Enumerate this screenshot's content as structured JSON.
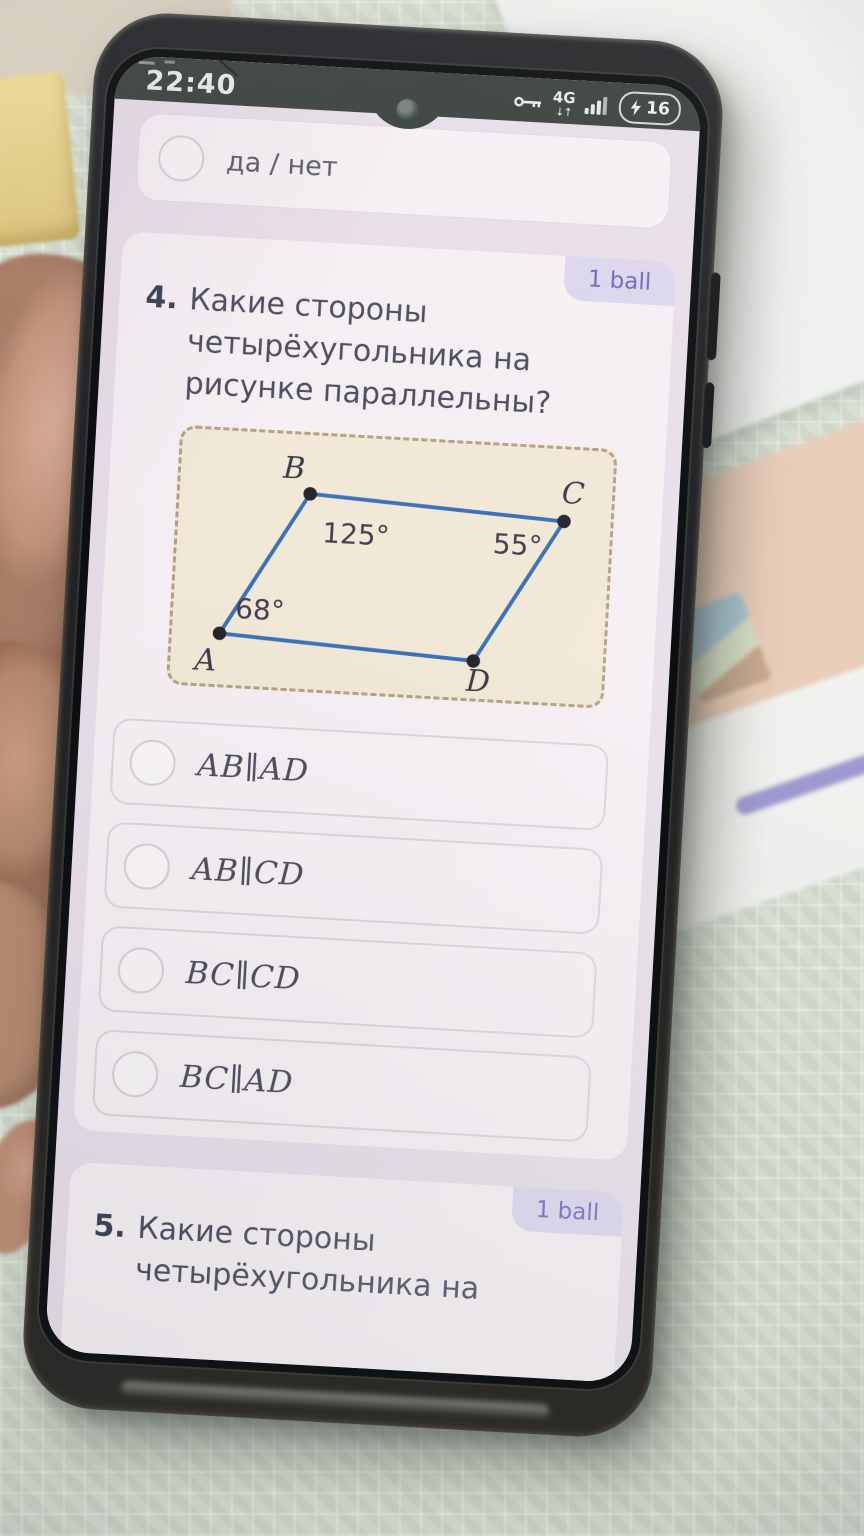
{
  "status_bar": {
    "time": "22:40",
    "network": "4G",
    "network_arrows": "↓↑",
    "battery": "16",
    "icons": {
      "vpn": "key-icon",
      "signal": "signal-bars-icon",
      "battery_charging": "charging-icon"
    }
  },
  "previous_question": {
    "option_label": "да / нет"
  },
  "question_4": {
    "points_badge": "1 ball",
    "number": "4.",
    "text": "Какие стороны четырёхугольника на рисунке параллельны?",
    "options": [
      {
        "label": "AB∥AD"
      },
      {
        "label": "AB∥CD"
      },
      {
        "label": "BC∥CD"
      },
      {
        "label": "BC∥AD"
      }
    ]
  },
  "question_5": {
    "points_badge": "1 ball",
    "number": "5.",
    "text": "Какие стороны четырёхугольника на"
  },
  "figure": {
    "type": "diagram",
    "shape": "parallelogram",
    "vertex_labels": {
      "A": "A",
      "B": "B",
      "C": "C",
      "D": "D"
    },
    "angle_labels": {
      "A": "68°",
      "B": "125°",
      "C": "55°"
    }
  },
  "colors": {
    "badge_bg": "#dcd6ee",
    "badge_text": "#6b68c2",
    "screen_bg": "#e7dee9",
    "card_bg": "#f5eff4",
    "figure_bg": "#f1e8d7",
    "figure_border": "#b3a280",
    "figure_line": "#3a72b8",
    "status_bar_bg": "#39413e"
  }
}
